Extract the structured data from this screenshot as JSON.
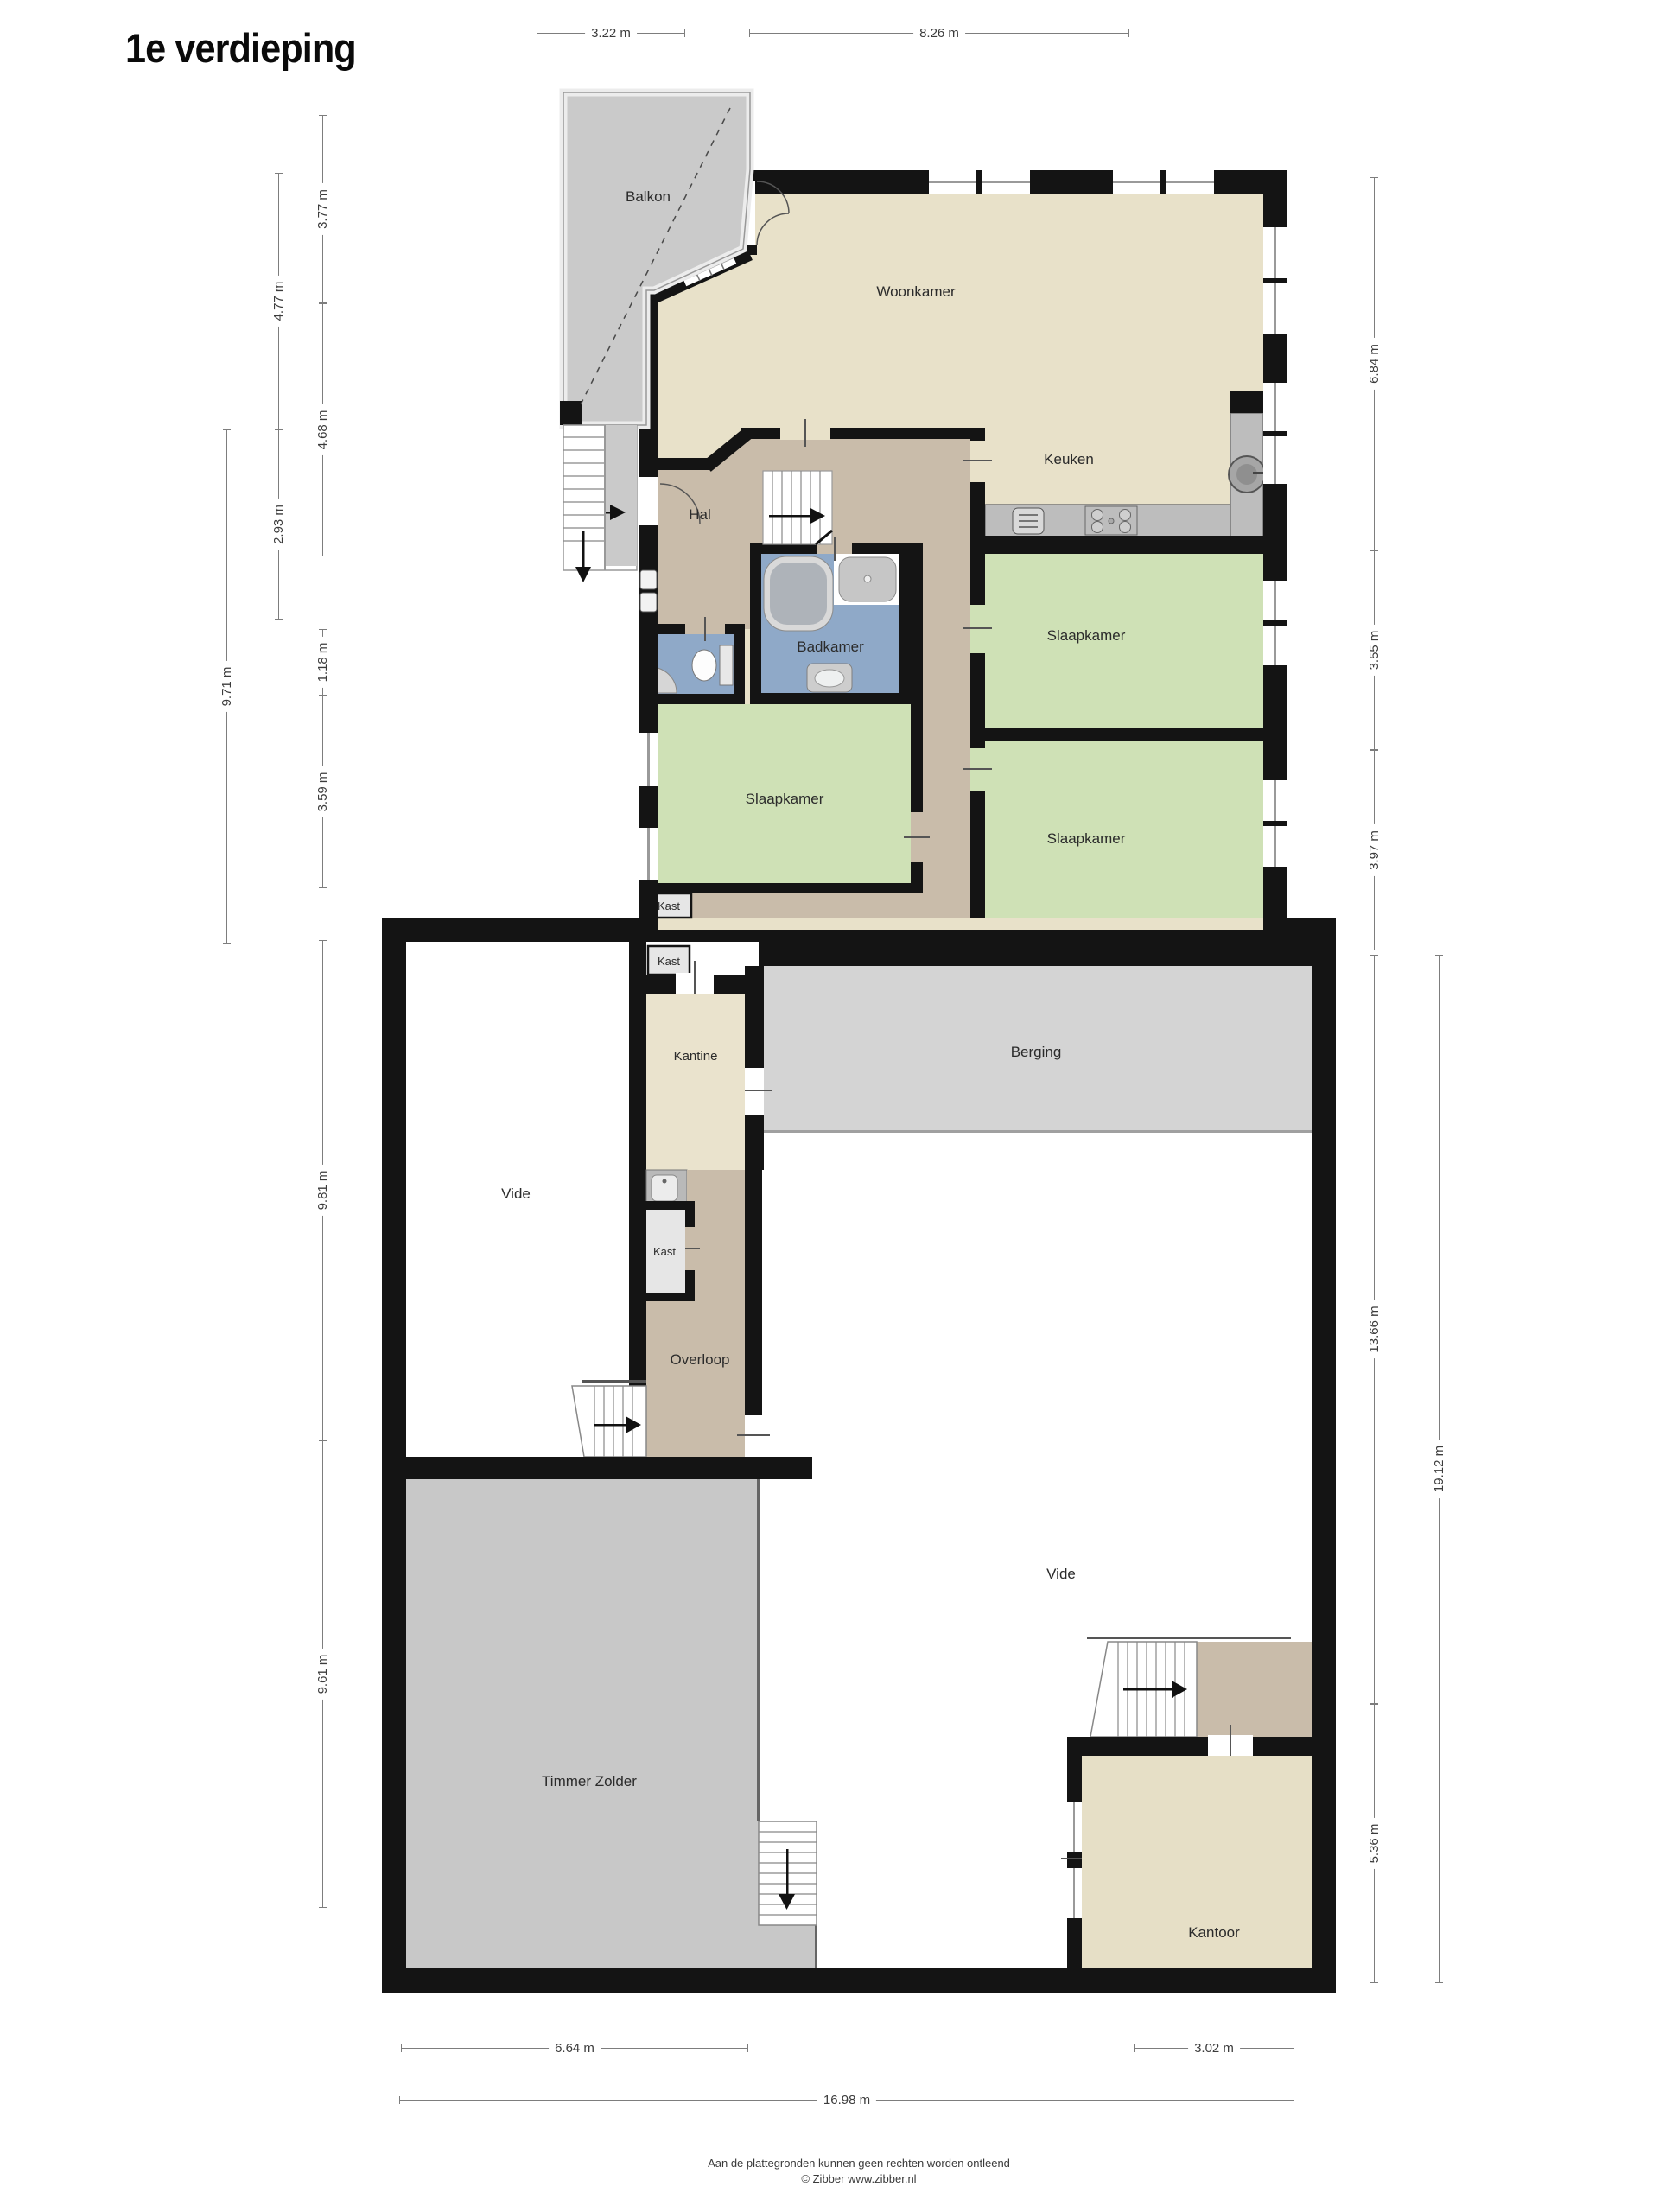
{
  "title": "1e verdieping",
  "rooms": {
    "balkon": "Balkon",
    "woonkamer": "Woonkamer",
    "keuken": "Keuken",
    "hal": "Hal",
    "badkamer": "Badkamer",
    "slaapkamer_rechts_1": "Slaapkamer",
    "slaapkamer_links": "Slaapkamer",
    "slaapkamer_rechts_2": "Slaapkamer",
    "kast_1": "Kast",
    "kast_2": "Kast",
    "kantine": "Kantine",
    "berging": "Berging",
    "vide_links": "Vide",
    "kast_3": "Kast",
    "overloop": "Overloop",
    "vide_rechts": "Vide",
    "timmer_zolder": "Timmer Zolder",
    "kantoor": "Kantoor"
  },
  "dimensions": {
    "top": {
      "d1": "3.22 m",
      "d2": "8.26 m"
    },
    "left": {
      "d1": "3.77 m",
      "d2": "4.77 m",
      "d3": "4.68 m",
      "d4": "2.93 m",
      "d5": "9.71 m",
      "d6": "1.18 m",
      "d7": "3.59 m",
      "d8": "9.81 m",
      "d9": "9.61 m"
    },
    "right": {
      "d1": "6.84 m",
      "d2": "3.55 m",
      "d3": "3.97 m",
      "d4": "13.66 m",
      "d5": "19.12 m",
      "d6": "5.36 m"
    },
    "bottom": {
      "d1": "6.64 m",
      "d2": "3.02 m",
      "d3": "16.98 m"
    }
  },
  "footer": {
    "line1": "Aan de plattegronden kunnen geen rechten worden ontleend",
    "line2": "© Zibber www.zibber.nl"
  },
  "colors": {
    "wall": "#141414",
    "living_beige": "#e8e1c9",
    "hall_taupe": "#c9bcaa",
    "bedroom_green": "#cfe1b6",
    "bath_blue": "#8fa9c8",
    "balcony_gray": "#cacaca",
    "storage_gray": "#d4d4d4",
    "attic_gray": "#c8c8c8",
    "canteen_cream": "#eae3cd",
    "office_cream": "#e6dfc6",
    "closet_gray": "#e6e6e6",
    "counter_gray": "#bdbdbd"
  }
}
